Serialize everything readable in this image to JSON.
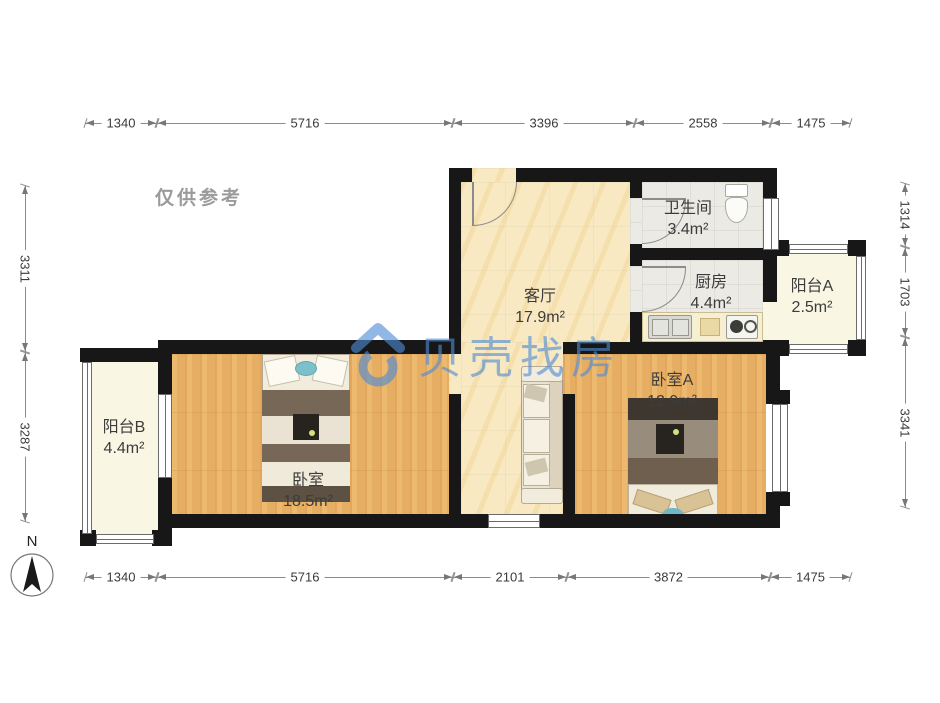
{
  "disclaimer": "仅供参考",
  "watermark": {
    "brand": "贝壳找房",
    "color": "#4f8cd6"
  },
  "compass": {
    "label": "N"
  },
  "rooms": {
    "living": {
      "name": "客厅",
      "area": "17.9m²"
    },
    "bath": {
      "name": "卫生间",
      "area": "3.4m²"
    },
    "kitchen": {
      "name": "厨房",
      "area": "4.4m²"
    },
    "balconyA": {
      "name": "阳台A",
      "area": "2.5m²"
    },
    "bedroomA": {
      "name": "卧室A",
      "area": "12.9m²"
    },
    "bedroom": {
      "name": "卧室",
      "area": "18.5m²"
    },
    "balconyB": {
      "name": "阳台B",
      "area": "4.4m²"
    }
  },
  "dimensions": {
    "top": {
      "y": 123,
      "segments": [
        {
          "label": "1340",
          "from": 85,
          "to": 157
        },
        {
          "label": "5716",
          "from": 157,
          "to": 453
        },
        {
          "label": "3396",
          "from": 453,
          "to": 635
        },
        {
          "label": "2558",
          "from": 635,
          "to": 771
        },
        {
          "label": "1475",
          "from": 771,
          "to": 851
        }
      ]
    },
    "bottom": {
      "y": 577,
      "segments": [
        {
          "label": "1340",
          "from": 85,
          "to": 157
        },
        {
          "label": "5716",
          "from": 157,
          "to": 453
        },
        {
          "label": "2101",
          "from": 453,
          "to": 567
        },
        {
          "label": "3872",
          "from": 567,
          "to": 770
        },
        {
          "label": "1475",
          "from": 770,
          "to": 851
        }
      ]
    },
    "left": {
      "x": 25,
      "segments": [
        {
          "label": "3311",
          "from": 185,
          "to": 352
        },
        {
          "label": "3287",
          "from": 352,
          "to": 522
        }
      ]
    },
    "right": {
      "x": 905,
      "segments": [
        {
          "label": "1314",
          "from": 183,
          "to": 247
        },
        {
          "label": "1703",
          "from": 247,
          "to": 337
        },
        {
          "label": "3341",
          "from": 337,
          "to": 508
        }
      ]
    }
  }
}
